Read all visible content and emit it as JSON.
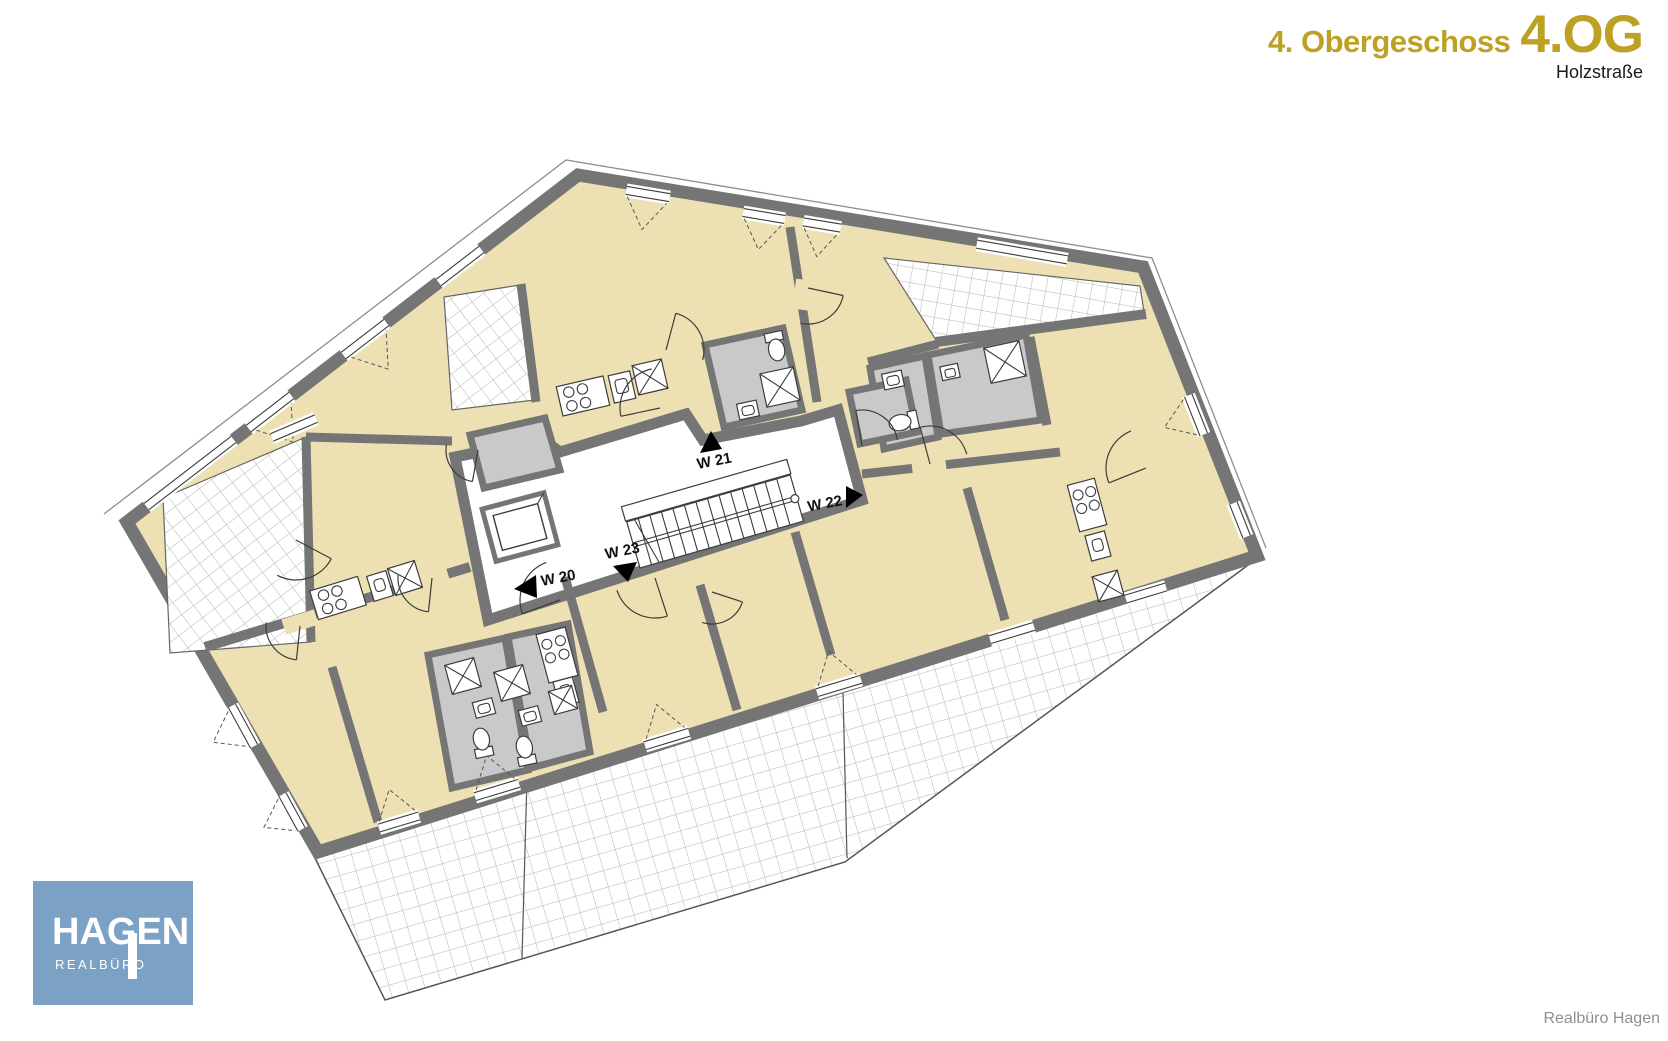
{
  "header": {
    "floor_name": "4. Obergeschoss",
    "floor_code": "4.OG",
    "street": "Holzstraße"
  },
  "plan": {
    "apartments": [
      {
        "id": "W 20",
        "arrow": "left"
      },
      {
        "id": "W 21",
        "arrow": "up"
      },
      {
        "id": "W 22",
        "arrow": "right"
      },
      {
        "id": "W 23",
        "arrow": "down"
      }
    ],
    "features": [
      "staircase",
      "elevator",
      "balconies",
      "terraces",
      "bathrooms",
      "kitchens"
    ]
  },
  "logo": {
    "name": "HAGEN",
    "subtitle": "REALBÜRO"
  },
  "footer": {
    "credit": "Realbüro Hagen"
  },
  "colors": {
    "accent_gold": "#bda125",
    "wall_gray": "#757575",
    "room_beige": "#ede1b4",
    "floor_gray": "#c9c9c9",
    "logo_blue": "#7ba1c5",
    "credit_gray": "#8f8f8f",
    "ink": "#1a1a1a"
  }
}
